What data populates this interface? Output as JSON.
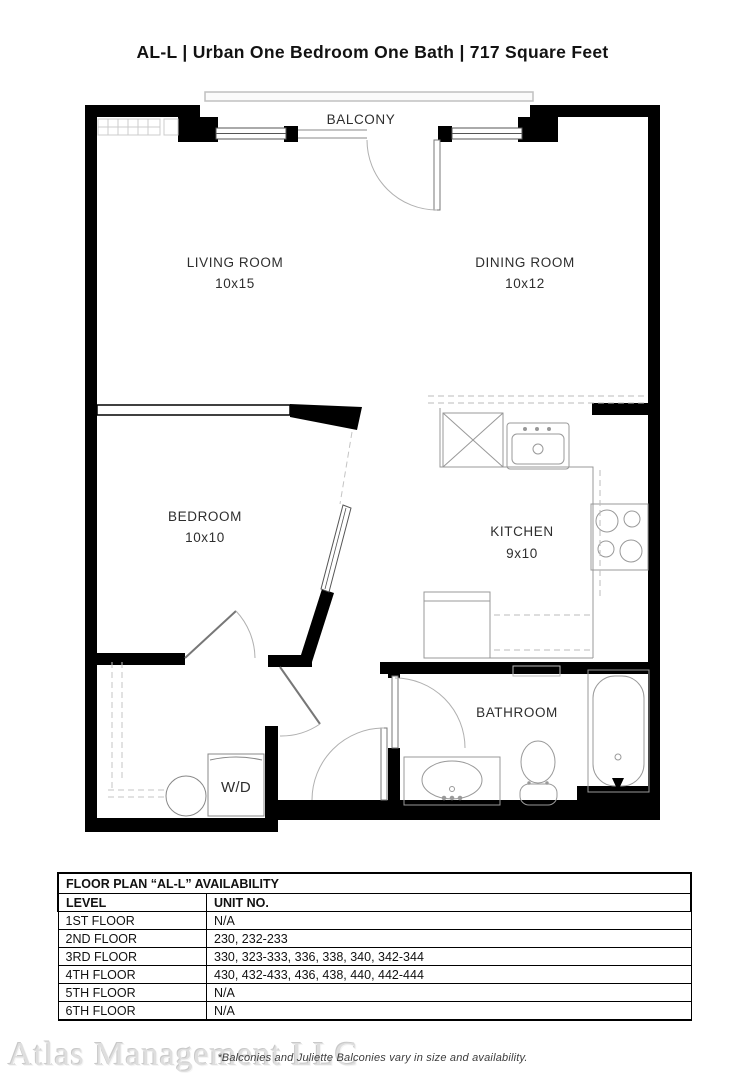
{
  "page": {
    "title": "AL-L | Urban One Bedroom One Bath | 717  Square Feet",
    "footnote": "*Balconies and Juliette Balconies vary in size and availability.",
    "watermark": "Atlas Management LLC"
  },
  "floorplan": {
    "balcony_label": "BALCONY",
    "wd_label": "W/D",
    "rooms": [
      {
        "label": "LIVING ROOM",
        "dims": "10x15"
      },
      {
        "label": "DINING ROOM",
        "dims": "10x12"
      },
      {
        "label": "BEDROOM",
        "dims": "10x10"
      },
      {
        "label": "KITCHEN",
        "dims": "9x10"
      },
      {
        "label": "BATHROOM",
        "dims": ""
      }
    ]
  },
  "availability_table": {
    "title": "FLOOR PLAN “AL-L” AVAILABILITY",
    "headers": [
      "LEVEL",
      "UNIT NO."
    ],
    "rows": [
      {
        "level": "1ST FLOOR",
        "units": "N/A"
      },
      {
        "level": "2ND FLOOR",
        "units": "230, 232-233"
      },
      {
        "level": "3RD FLOOR",
        "units": "330, 323-333, 336, 338, 340, 342-344"
      },
      {
        "level": "4TH FLOOR",
        "units": "430, 432-433, 436, 438, 440, 442-444"
      },
      {
        "level": "5TH FLOOR",
        "units": "N/A"
      },
      {
        "level": "6TH FLOOR",
        "units": "N/A"
      }
    ]
  },
  "colors": {
    "wall": "#000000",
    "fixture_stroke": "#999999",
    "dashed_stroke": "#bbbbbb",
    "label_text": "#2e2e2e"
  }
}
